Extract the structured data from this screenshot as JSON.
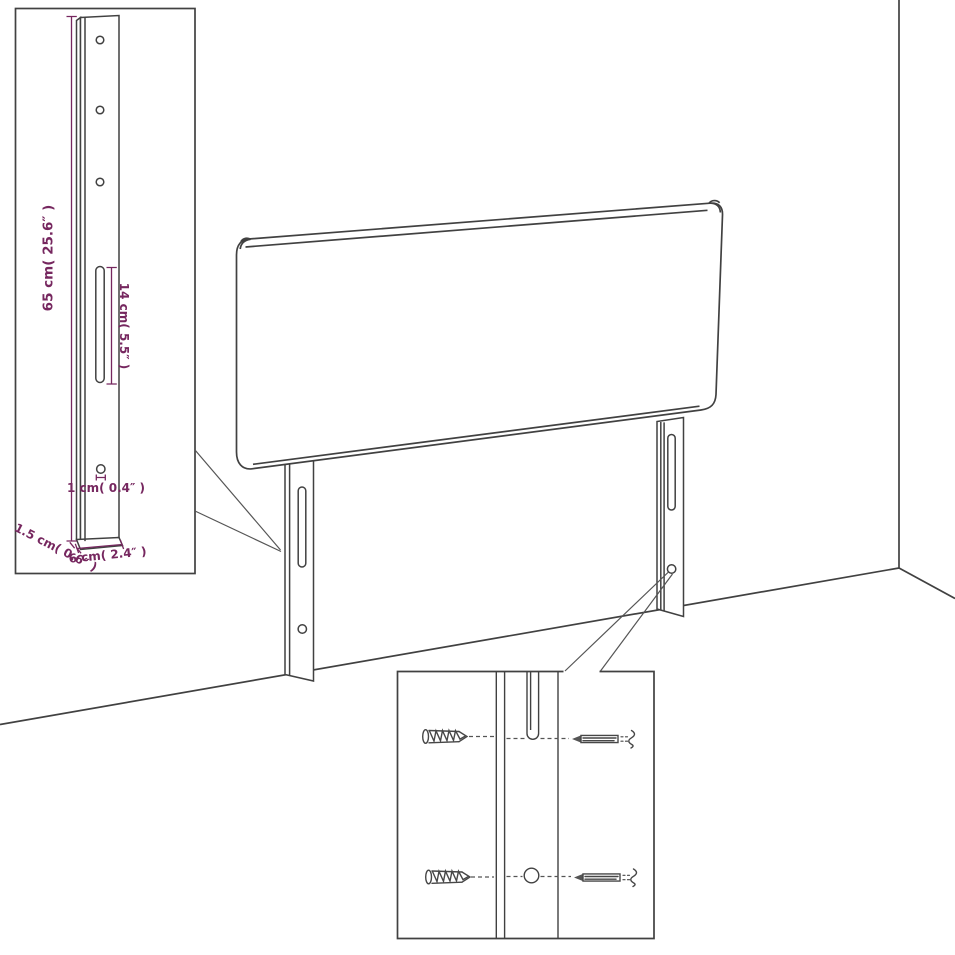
{
  "diagram": {
    "title": "Headboard with wall-mount legs dimension drawing",
    "background": "#ffffff",
    "line_color": "#414141",
    "dimension_color": "#76275f",
    "views": {
      "main": "3/4 perspective of upholstered headboard panel with two slotted legs standing in a room corner",
      "leg_side_view_inset": "side view of one leg with dimensions",
      "mounting_detail_inset": "close-up of leg slot and hole with screws and bolts"
    },
    "dimensions": {
      "leg_height": "65 cm( 25.6″ )",
      "slot_length": "14 cm( 5.5″ )",
      "hole_diameter": "1 cm( 0.4″ )",
      "leg_thickness": "1.5 cm( 0.6″ )",
      "leg_width": "6 cm( 2.4″ )"
    },
    "hardware": [
      "wood-screw",
      "bolt",
      "wood-screw",
      "bolt"
    ]
  }
}
